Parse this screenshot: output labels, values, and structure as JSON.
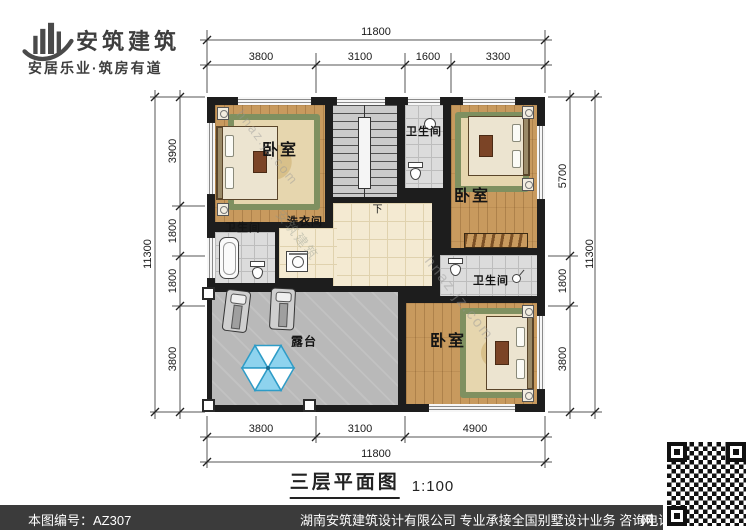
{
  "header": {
    "brand": "安筑建筑",
    "tagline": "安居乐业·筑房有道"
  },
  "plan": {
    "title": "三层平面图",
    "scale": "1:100",
    "labels": {
      "bedroom": "卧室",
      "bathroom": "卫生间",
      "laundry": "洗衣间",
      "terrace": "露台",
      "down": "下"
    },
    "dims": {
      "top": {
        "total": "11800",
        "segments": [
          "3800",
          "3100",
          "1600",
          "3300"
        ]
      },
      "bottom": {
        "total": "11800",
        "segments": [
          "3800",
          "3100",
          "4900"
        ]
      },
      "left": {
        "total": "11300",
        "segments": [
          "3900",
          "1800",
          "1800",
          "3800"
        ]
      },
      "right": {
        "total": "11300",
        "segments": [
          "5700",
          "1800",
          "3800"
        ]
      }
    }
  },
  "footer": {
    "drawing_no": "本图编号：AZ307",
    "company": "湖南安筑建筑设计有限公司  专业承接全国别墅设计业务  咨询电话：400-8070-511",
    "site": "网"
  },
  "watermarks": [
    "hnaz.jz.com",
    "安筑建筑"
  ],
  "colors": {
    "wall": "#1d1d1d",
    "wood_floor": "#c89a5e",
    "tile_floor": "#dcdcdc",
    "hall_floor": "#f4ead2",
    "terrace_floor": "#b9b9b9",
    "umbrella_blue": "#8ed3ee",
    "footer_bg": "#3b3b3b"
  }
}
